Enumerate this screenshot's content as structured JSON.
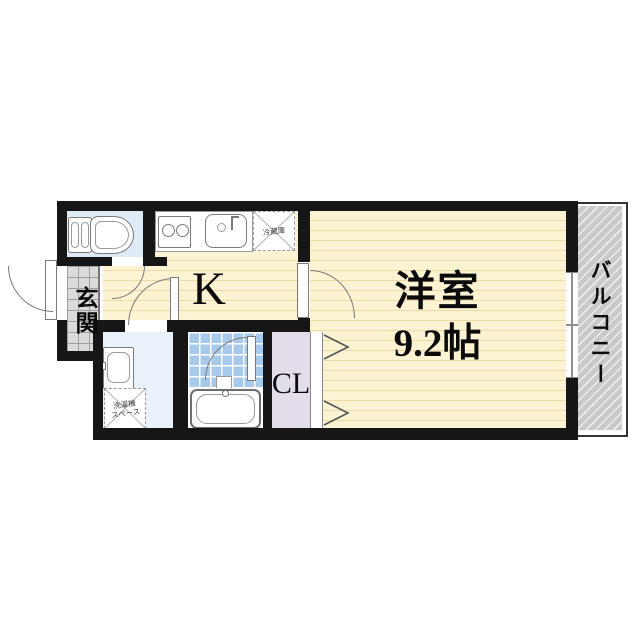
{
  "floor_plan": {
    "labels": {
      "entrance": "玄関",
      "kitchen": "K",
      "main_room": "洋室",
      "main_room_size": "9.2帖",
      "balcony": "バルコニー",
      "closet": "CL",
      "refrigerator": "冷蔵庫",
      "washer_space_line1": "洗濯機",
      "washer_space_line2": "スペース"
    },
    "colors": {
      "wall": "#161616",
      "flooring": "#FBF3D2",
      "flooring-stripe": "#EFD9A4",
      "toilet-room": "#DEEBF7",
      "washroom": "#E9F2FA",
      "bath-tile": "#A6C9EC",
      "bath-grid": "#FFFFFF",
      "closet-fill": "#E2DDE8",
      "genkan-tile": "#DBDBDB",
      "genkan-grid": "#9E9E9E",
      "balcony-fill": "#C9C9C9",
      "fixture-line": "#7A7A7A"
    }
  }
}
